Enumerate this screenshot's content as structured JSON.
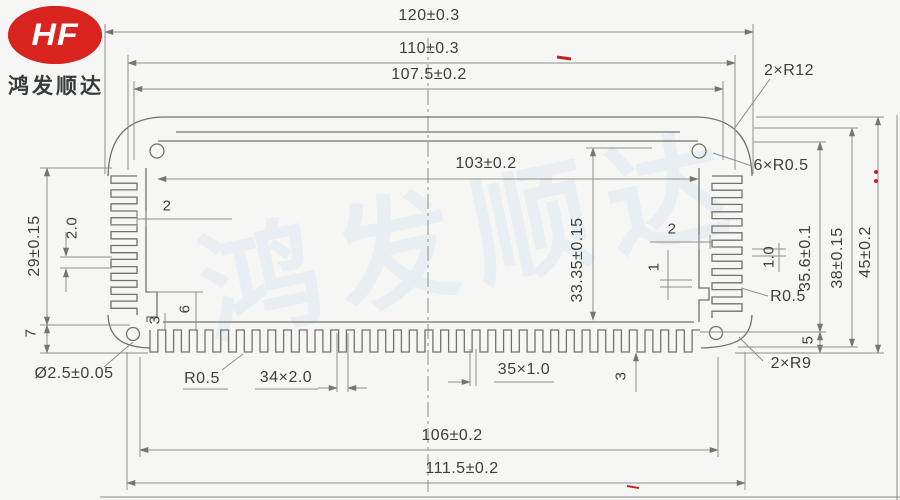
{
  "logo": {
    "brand": "HF",
    "company": "鸿发顺达"
  },
  "watermark": {
    "text": "鸿发顺达"
  },
  "dimensions": {
    "top": {
      "overall": "120±0.3",
      "outer": "110±0.3",
      "inner": "107.5±0.2",
      "slot": "103±0.2"
    },
    "bottom": {
      "fin_span": "106±0.2",
      "outer": "111.5±0.2"
    },
    "left": {
      "fin_zone": "29±0.15",
      "fin_pitch": "2.0",
      "corner": "7",
      "hole": "Ø2.5±0.05",
      "wall": "2",
      "step_depth": "6",
      "step": "3"
    },
    "right": {
      "cavity_depth": "33.35±0.15",
      "inner_height": "35.6±0.1",
      "body_height": "38±0.15",
      "overall_height": "45±0.2",
      "base": "5",
      "wall": "2",
      "rib": "1",
      "fin_gap": "1.0"
    },
    "bottom_fins": {
      "radius": "R0.5",
      "pitch": "34×2.0",
      "count": "35×1.0",
      "height": "3"
    },
    "radii": {
      "corner_top": "2×R12",
      "fillets_top": "6×R0.5",
      "fillet_right": "R0.5",
      "corner_bottom": "2×R9"
    }
  }
}
